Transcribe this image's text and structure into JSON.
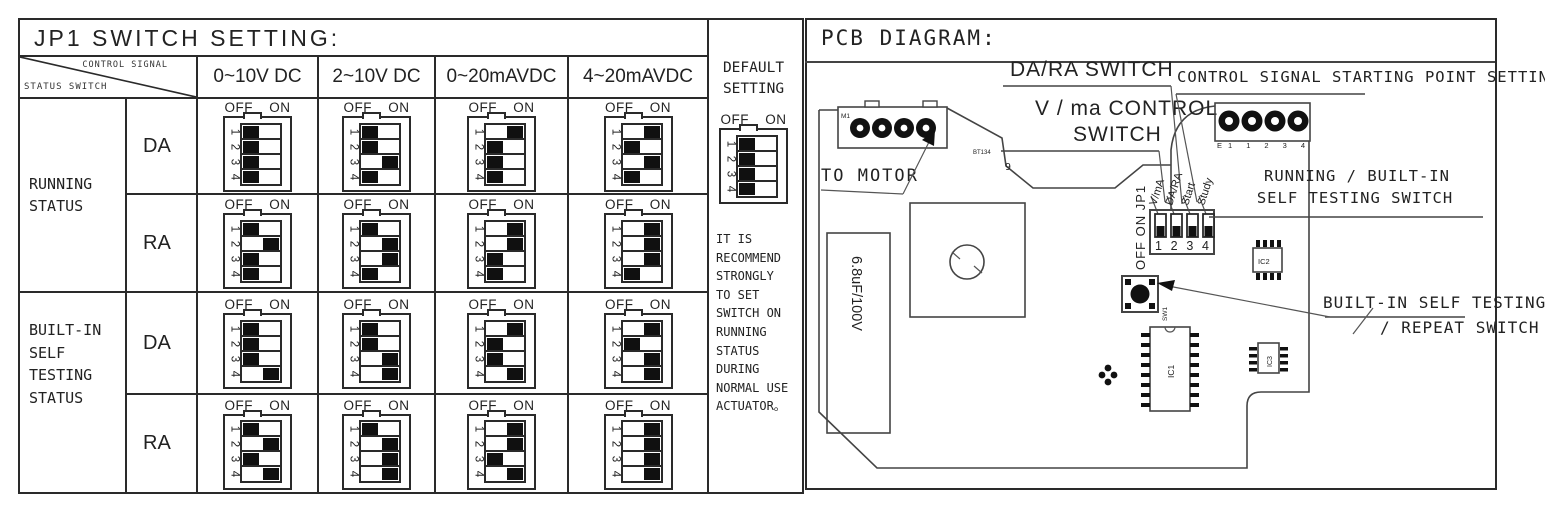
{
  "left_panel": {
    "title": "JP1 SWITCH SETTING:",
    "corner": {
      "top": "CONTROL SIGNAL",
      "bottom": "STATUS SWITCH"
    },
    "columns": [
      "0~10V DC",
      "2~10V DC",
      "0~20mAVDC",
      "4~20mAVDC"
    ],
    "dip_labels": {
      "off": "OFF",
      "on": "ON",
      "positions": [
        "1",
        "2",
        "3",
        "4"
      ]
    },
    "row_groups": [
      {
        "label": "RUNNING\nSTATUS",
        "rows": [
          {
            "mode": "DA",
            "cells": [
              [
                "OFF",
                "OFF",
                "OFF",
                "OFF"
              ],
              [
                "OFF",
                "OFF",
                "ON",
                "OFF"
              ],
              [
                "ON",
                "OFF",
                "OFF",
                "OFF"
              ],
              [
                "ON",
                "OFF",
                "ON",
                "OFF"
              ]
            ]
          },
          {
            "mode": "RA",
            "cells": [
              [
                "OFF",
                "ON",
                "OFF",
                "OFF"
              ],
              [
                "OFF",
                "ON",
                "ON",
                "OFF"
              ],
              [
                "ON",
                "ON",
                "OFF",
                "OFF"
              ],
              [
                "ON",
                "ON",
                "ON",
                "OFF"
              ]
            ]
          }
        ]
      },
      {
        "label": "BUILT-IN\nSELF\nTESTING\nSTATUS",
        "rows": [
          {
            "mode": "DA",
            "cells": [
              [
                "OFF",
                "OFF",
                "OFF",
                "ON"
              ],
              [
                "OFF",
                "OFF",
                "ON",
                "ON"
              ],
              [
                "ON",
                "OFF",
                "OFF",
                "ON"
              ],
              [
                "ON",
                "OFF",
                "ON",
                "ON"
              ]
            ]
          },
          {
            "mode": "RA",
            "cells": [
              [
                "OFF",
                "ON",
                "OFF",
                "ON"
              ],
              [
                "OFF",
                "ON",
                "ON",
                "ON"
              ],
              [
                "ON",
                "ON",
                "OFF",
                "ON"
              ],
              [
                "ON",
                "ON",
                "ON",
                "ON"
              ]
            ]
          }
        ]
      }
    ],
    "default_column": {
      "title": "DEFAULT\nSETTING",
      "switch": [
        "OFF",
        "OFF",
        "OFF",
        "OFF"
      ],
      "note": "IT IS\nRECOMMEND\nSTRONGLY\nTO SET\nSWITCH ON\nRUNNING\nSTATUS\nDURING\nNORMAL USE\nACTUATOR。"
    }
  },
  "pcb": {
    "title": "PCB DIAGRAM:",
    "labels": {
      "da_ra_switch": "DA/RA SWITCH",
      "v_ma_line1": "V / ma CONTROL",
      "v_ma_line2": "SWITCH",
      "control_signal_setting": "CONTROL SIGNAL STARTING POINT SETTING",
      "running_builtin_line1": "RUNNING / BUILT-IN",
      "running_builtin_line2": "SELF TESTING SWITCH",
      "builtin_repeat_line1": "BUILT-IN SELF TESTING",
      "builtin_repeat_line2": "/ REPEAT SWITCH",
      "to_motor": "TO MOTOR"
    },
    "components": {
      "motor_connector": "M1",
      "triac": "BT134",
      "pin9": "9",
      "capacitor": "6.8uF/100V",
      "terminal_pins": "E1 1 2 3 4",
      "push_button": "SW1",
      "ic1": "IC1",
      "ic2": "IC2",
      "ic3": "IC3"
    },
    "jp1": {
      "off_on_label": "OFF ON JP1",
      "numbers": "1 2 3 4",
      "pin_labels": [
        "V/mA",
        "DA/RA",
        "Start",
        "Study"
      ],
      "states": [
        "OFF",
        "OFF",
        "OFF",
        "OFF"
      ]
    }
  }
}
